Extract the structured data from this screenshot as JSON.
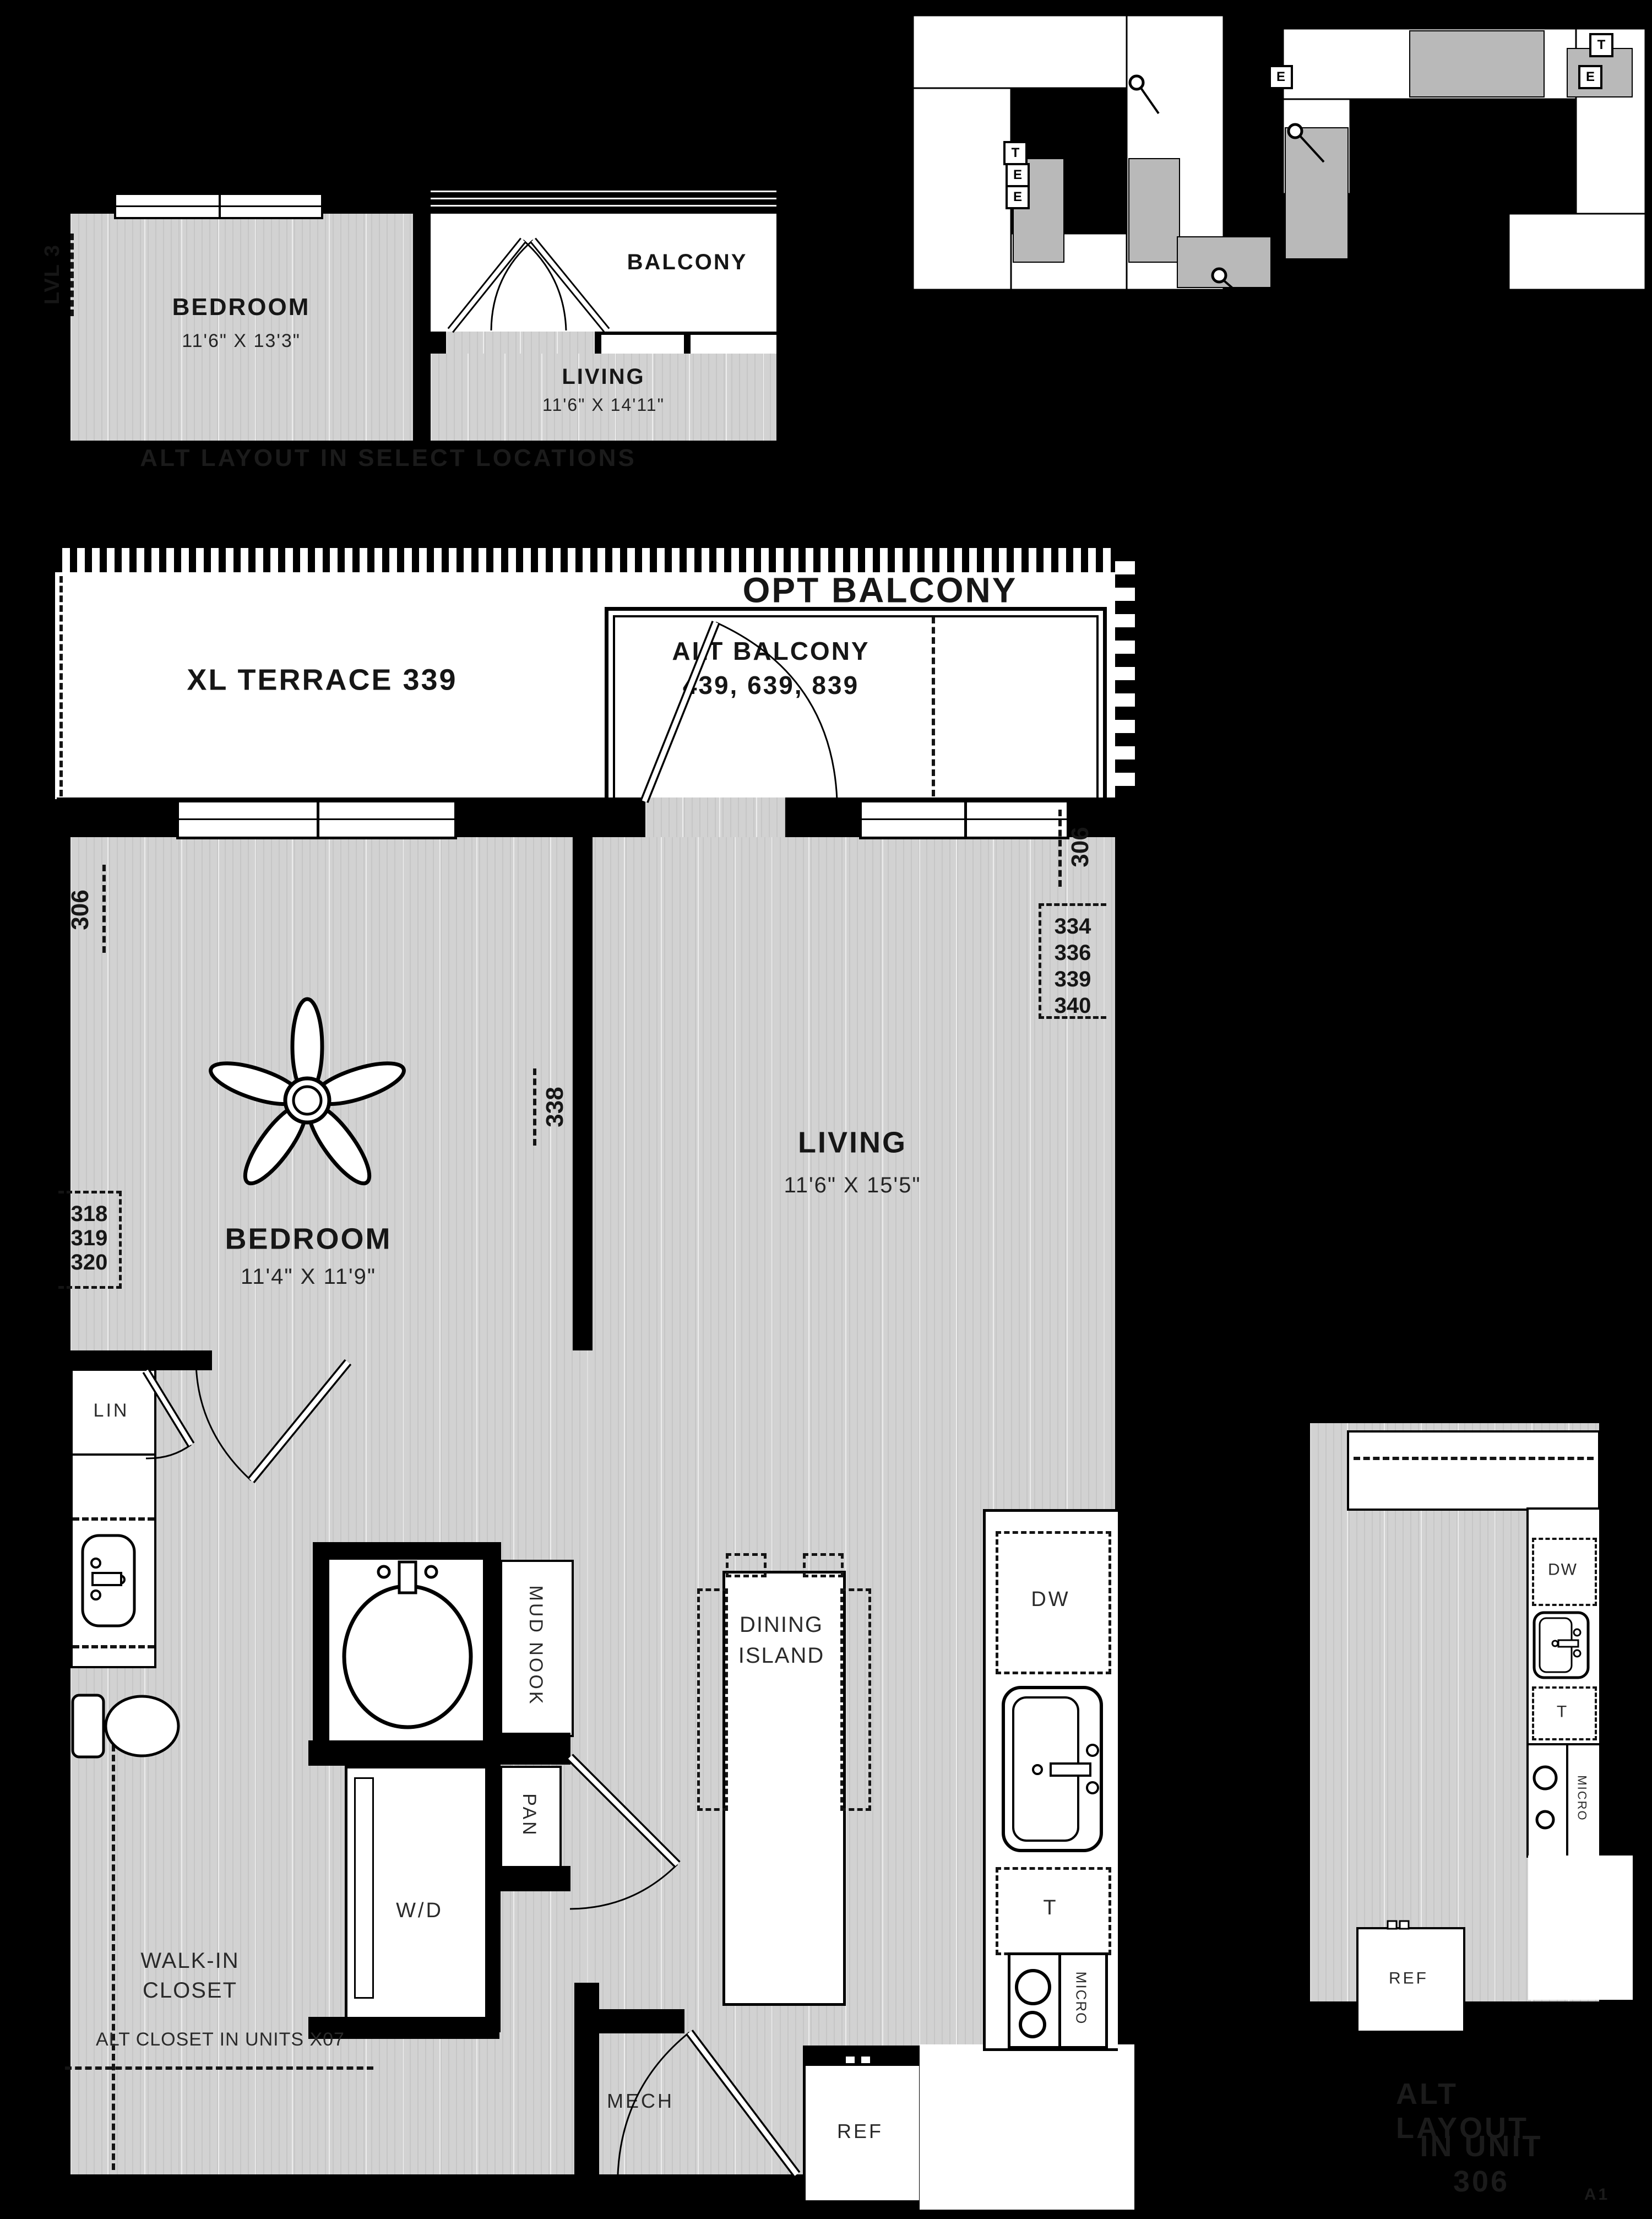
{
  "page": {
    "code": "A1"
  },
  "alt_top": {
    "level": "LVL 3",
    "bedroom": "BEDROOM",
    "bedroom_dims": "11'6\" X 13'3\"",
    "balcony": "BALCONY",
    "living": "LIVING",
    "living_dims": "11'6\" X 14'11\"",
    "note": "ALT LAYOUT IN SELECT LOCATIONS"
  },
  "keyplan": {
    "e": "E",
    "t": "T"
  },
  "main": {
    "opt_balcony": "OPT BALCONY",
    "xl_terrace": "XL TERRACE 339",
    "alt_balcony_1": "ALT BALCONY",
    "alt_balcony_2": "439, 639, 839",
    "unit_306": "306",
    "unit_338": "338",
    "stack_right": [
      "334",
      "336",
      "339",
      "340"
    ],
    "stack_left": [
      "318",
      "319",
      "320"
    ],
    "bedroom": "BEDROOM",
    "bedroom_dims": "11'4\" X 11'9\"",
    "living": "LIVING",
    "living_dims": "11'6\" X 15'5\"",
    "lin": "LIN",
    "mud_nook": "MUD NOOK",
    "pan": "PAN",
    "wd": "W/D",
    "walk_in_1": "WALK-IN",
    "walk_in_2": "CLOSET",
    "alt_closet_note": "ALT CLOSET IN UNITS X07",
    "mech": "MECH",
    "ref": "REF",
    "dw": "DW",
    "t": "T",
    "micro": "MICRO",
    "dining_1": "DINING",
    "dining_2": "ISLAND"
  },
  "alt306": {
    "dw": "DW",
    "t": "T",
    "micro": "MICRO",
    "ref": "REF",
    "note_1": "ALT LAYOUT",
    "note_2": "IN UNIT",
    "note_3": "306"
  }
}
